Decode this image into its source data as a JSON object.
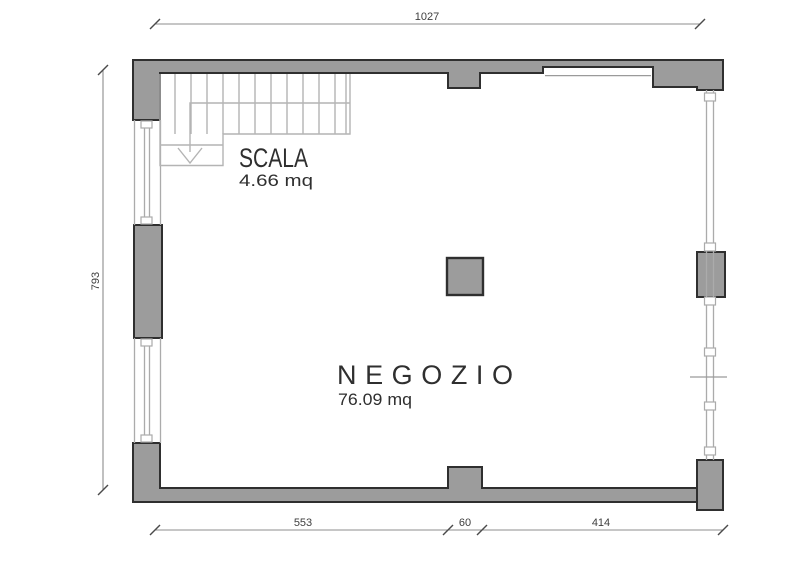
{
  "plan": {
    "rooms": [
      {
        "name": "NEGOZIO",
        "area": "76.09 mq"
      },
      {
        "name": "SCALA",
        "area": "4.66 mq"
      }
    ],
    "dimensions": {
      "top": "1027",
      "left": "793",
      "bottom_left": "553",
      "bottom_center": "60",
      "bottom_right": "414"
    }
  }
}
